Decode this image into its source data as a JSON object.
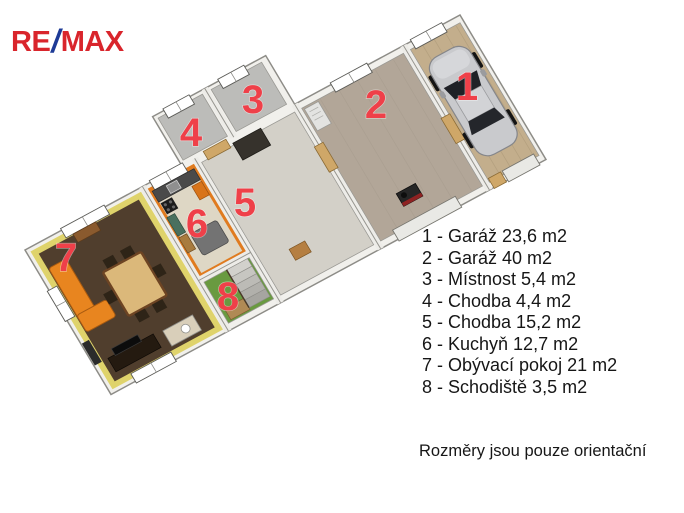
{
  "brand": {
    "re": "RE",
    "slash": "/",
    "max": "MAX",
    "red": "#d9252c",
    "blue": "#1d3a96"
  },
  "legend": {
    "items": [
      {
        "id": "1",
        "name": "Garáž",
        "area": "23,6 m2",
        "label": "1 - Garáž 23,6 m2"
      },
      {
        "id": "2",
        "name": "Garáž",
        "area": "40 m2",
        "label": "2 - Garáž 40 m2"
      },
      {
        "id": "3",
        "name": "Místnost",
        "area": "5,4 m2",
        "label": "3 - Místnost 5,4 m2"
      },
      {
        "id": "4",
        "name": "Chodba",
        "area": "4,4 m2",
        "label": "4 - Chodba 4,4 m2"
      },
      {
        "id": "5",
        "name": "Chodba",
        "area": "15,2 m2",
        "label": "5 - Chodba 15,2 m2"
      },
      {
        "id": "6",
        "name": "Kuchyň",
        "area": "12,7 m2",
        "label": "6 - Kuchyň 12,7 m2"
      },
      {
        "id": "7",
        "name": "Obývací pokoj",
        "area": "21 m2",
        "label": "7 - Obývací pokoj 21 m2"
      },
      {
        "id": "8",
        "name": "Schodiště",
        "area": "3,5 m2",
        "label": "8 - Schodiště 3,5 m2"
      }
    ]
  },
  "footer": {
    "note": "Rozměry jsou pouze orientační"
  },
  "plan": {
    "number_color": "#ef4049",
    "colors": {
      "wall": "#f1f0ec",
      "living_wall_yellow": "#dfd36b",
      "living_floor": "#503e2d",
      "kitchen_wall_orange": "#e07b1f",
      "kitchen_floor": "#ded7c5",
      "hall_floor": "#d3d0c8",
      "stairs_floor": "#699a40",
      "small_room_floor": "#bcbcb9",
      "garage2_floor": "#b2a698",
      "garage1_floor": "#c3ae8c",
      "sofa_orange": "#e8851f",
      "car_silver": "#c9cacd"
    }
  }
}
